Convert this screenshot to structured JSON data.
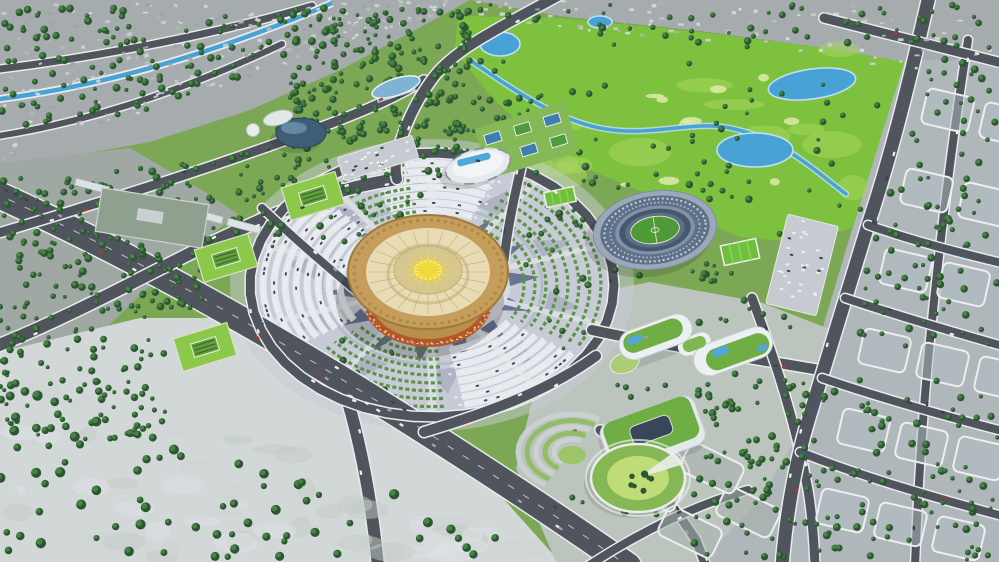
{
  "meta": {
    "title": "Aerial 3D masterplan rendering of a sports and culture complex",
    "description": "Bird's-eye architectural visualization: a golden circular arena with a sunburst roof sits on a radial plaza with fan-shaped parking and garden arcs; around it are an oval stadium, a golf course with ponds and a stream, white halls, green-roof buildings, wide boulevards and tree-filled city blocks; grey existing city fabric frames the plan.",
    "visible_text": []
  },
  "landmarks": [
    {
      "name": "golden-arena",
      "label": "Circular golden arena with sunburst roof"
    },
    {
      "name": "radial-plaza",
      "label": "Radial plaza with triangular paving ornament"
    },
    {
      "name": "fan-parking",
      "label": "Fan-shaped parking arcs filled with cars"
    },
    {
      "name": "fan-gardens",
      "label": "Fan-shaped garden hedge arcs"
    },
    {
      "name": "stadium",
      "label": "Oval stadium with blue tiers and green pitch"
    },
    {
      "name": "golf-course",
      "label": "Golf course with ponds and winding stream"
    },
    {
      "name": "aquatic-center",
      "label": "White oval-roof sports hall with pool strip"
    },
    {
      "name": "dome-hall",
      "label": "Dark elliptical dome hall"
    },
    {
      "name": "lens-pavilion",
      "label": "Blue lens-shaped pavilion"
    },
    {
      "name": "tennis-courts",
      "label": "Tennis court cluster on lawn"
    },
    {
      "name": "green-roof-offices",
      "label": "White buildings with green roofs and rooftop pools"
    },
    {
      "name": "courtyard-building",
      "label": "Green-roof building with dark courtyard"
    },
    {
      "name": "terraced-round-building",
      "label": "Round terraced landscape building"
    },
    {
      "name": "amphitheater-park",
      "label": "Terraced amphitheater garden"
    },
    {
      "name": "main-boulevard",
      "label": "Wide diagonal boulevard with traffic"
    },
    {
      "name": "old-town",
      "label": "Grey existing city fabric"
    },
    {
      "name": "canal",
      "label": "Blue canal through the old town"
    },
    {
      "name": "city-grid",
      "label": "Tree-filled urban grid blocks"
    }
  ],
  "palette": {
    "parkGreen": "#7CA855",
    "golfGreen": "#7DC13E",
    "golfLight": "#A6D65C",
    "sand": "#D9E8A3",
    "lawn": "#8CC94B",
    "grayCityGround": "#A6ABAD",
    "leftCityGround": "#9FA8A3",
    "bottomLeftGround": "#D2D7D8",
    "rightCityGround": "#AFB7BB",
    "seGround": "#BCC4BE",
    "blockFill": "#B4BDC1",
    "curb": "#ECEEEF",
    "road": "#50555D",
    "roadEdge": "#E9EBEC",
    "laneMark": "#D8DCE0",
    "water": "#49A2D6",
    "waterEdge": "#BFE0F2",
    "plazaPaving": "#C7CBD5",
    "plazaLight": "#DDDFE6",
    "ornament": "#4E5C80",
    "ornamentLight": "#9AA5BE",
    "hedge": "#5E9447",
    "arenaGold": "#C59E5C",
    "arenaGoldDark": "#9E7B3C",
    "arenaRoofCream": "#E9DCB4",
    "arenaDisc": "#D6C68F",
    "sun": "#F2D93B",
    "drum": "#B88F4B",
    "drumBand": "#B2592B",
    "stadiumOuter": "#9BA8B9",
    "stadiumTier": "#5F7089",
    "pitch": "#4E9A36",
    "white": "#EDF0F2",
    "greenRoof": "#6FAE45",
    "pool": "#4FA8D8",
    "treeDark": "#2B5632",
    "treeCap": "#4C8845",
    "carDark": "#3A424B"
  }
}
